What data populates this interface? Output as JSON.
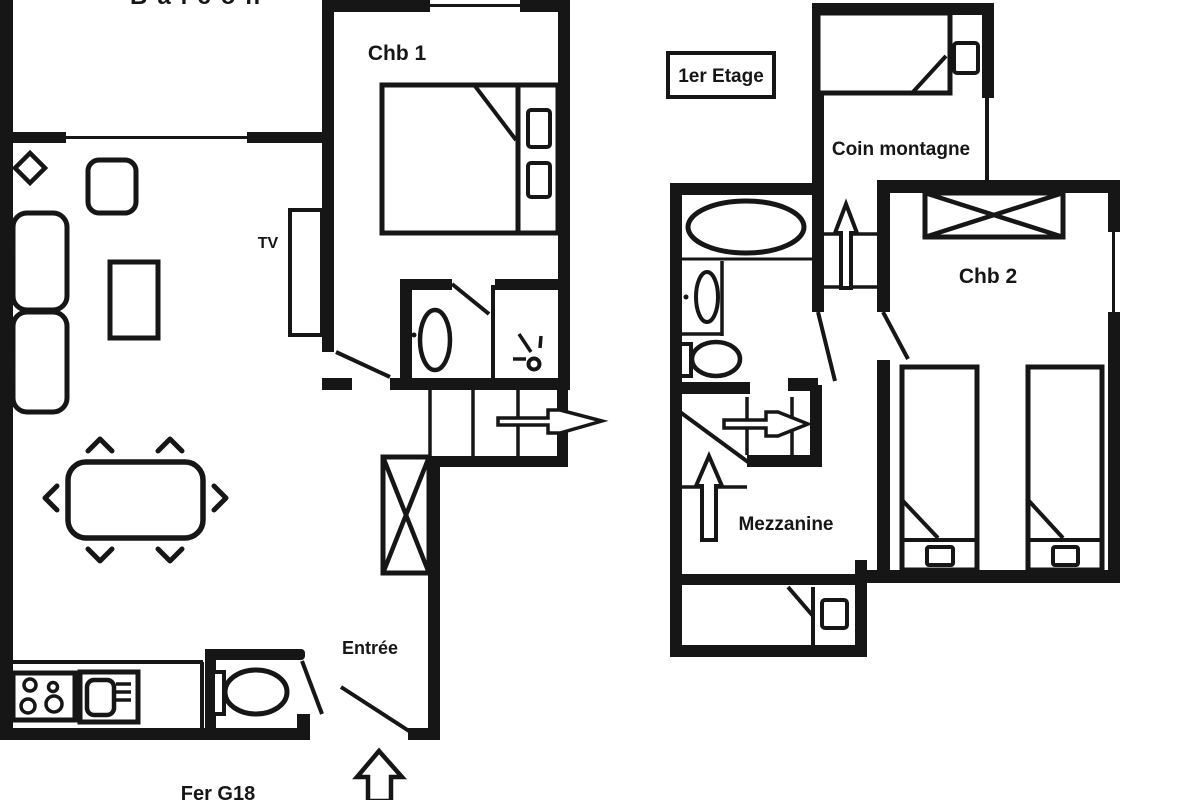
{
  "title": "Apartment floor plan",
  "colors": {
    "ink": "#161616",
    "paper": "#ffffff"
  },
  "ground_floor": {
    "balcony_label": "Balcon",
    "bedroom1_label": "Chb 1",
    "tv_label": "TV",
    "entrance_label": "Entrée",
    "reference_label": "Fer G18"
  },
  "first_floor": {
    "floor_label": "1er Etage",
    "mountain_corner_label": "Coin montagne",
    "bedroom2_label": "Chb 2",
    "mezzanine_label": "Mezzanine"
  }
}
